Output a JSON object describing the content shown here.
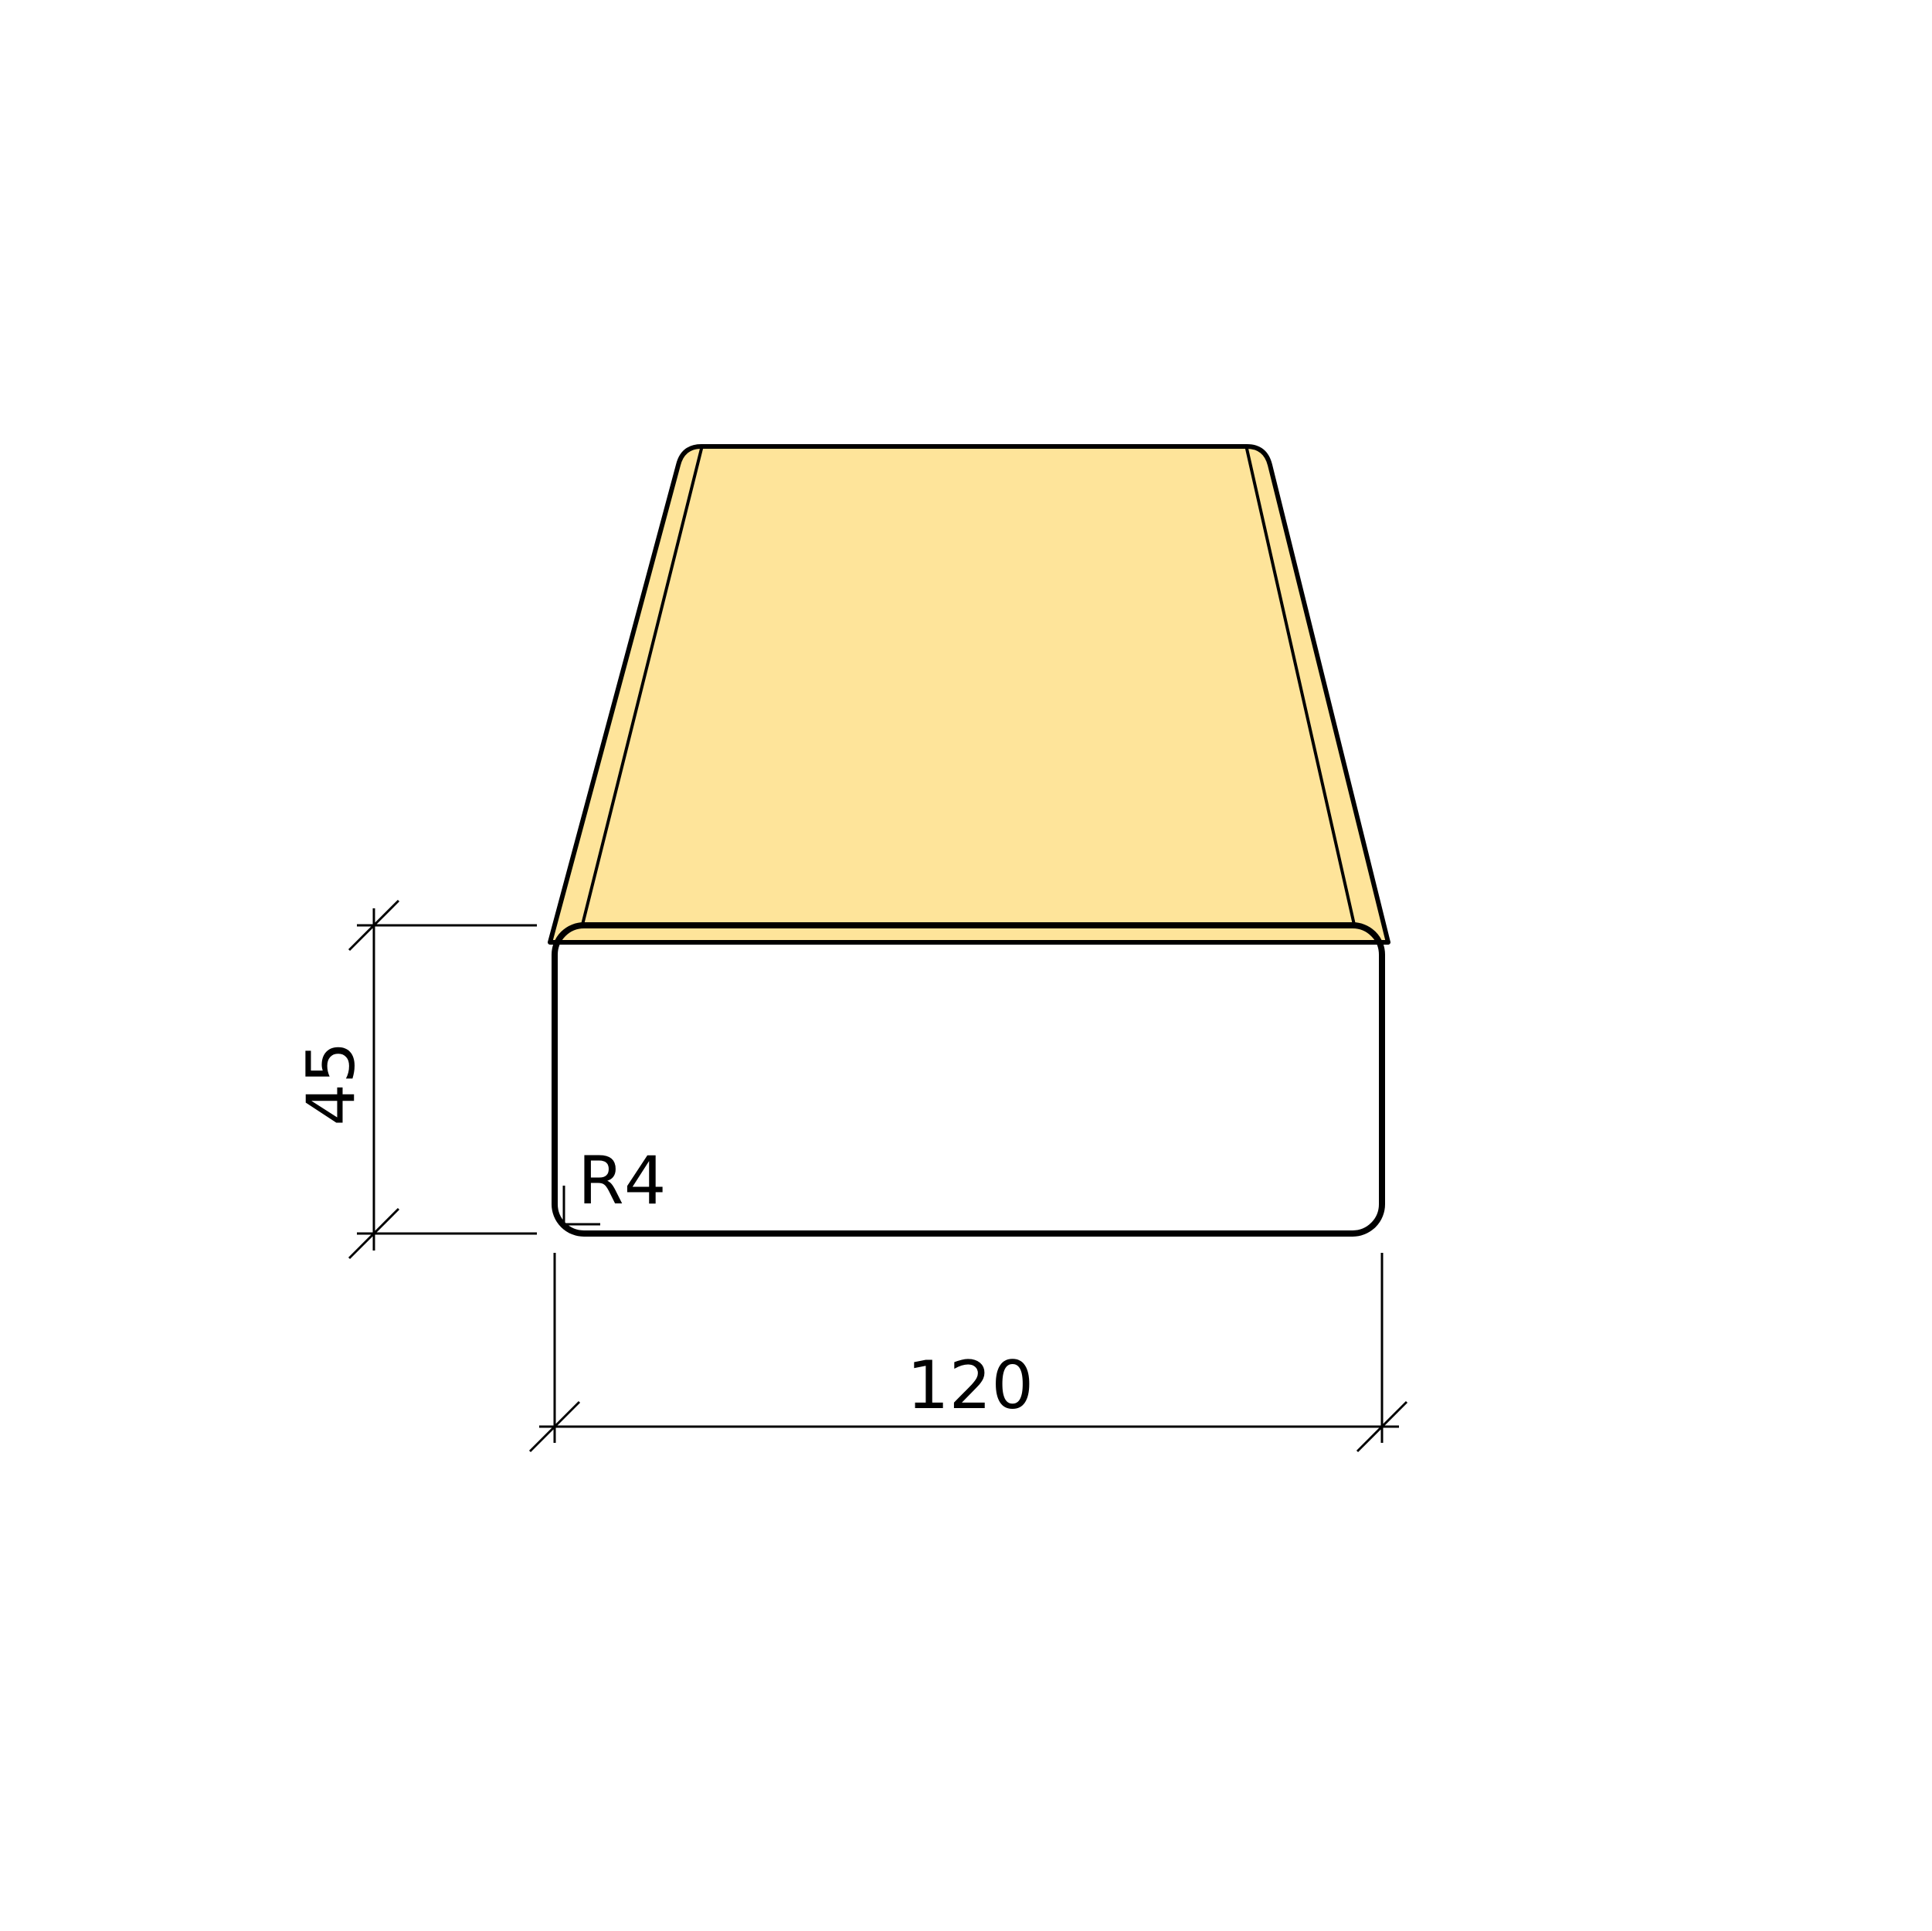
{
  "drawing": {
    "kind": "timber-profile-technical-drawing",
    "labels": {
      "height": "45",
      "width": "120",
      "corner_radius": "R4"
    },
    "values": {
      "height_mm": 45,
      "width_mm": 120,
      "corner_radius_mm": 4
    },
    "colors": {
      "top_face": "#FEE49A",
      "edge_band": "#FBE093",
      "front_face": "#FCD07A",
      "line": "#000000",
      "background": "#FFFFFF"
    }
  }
}
